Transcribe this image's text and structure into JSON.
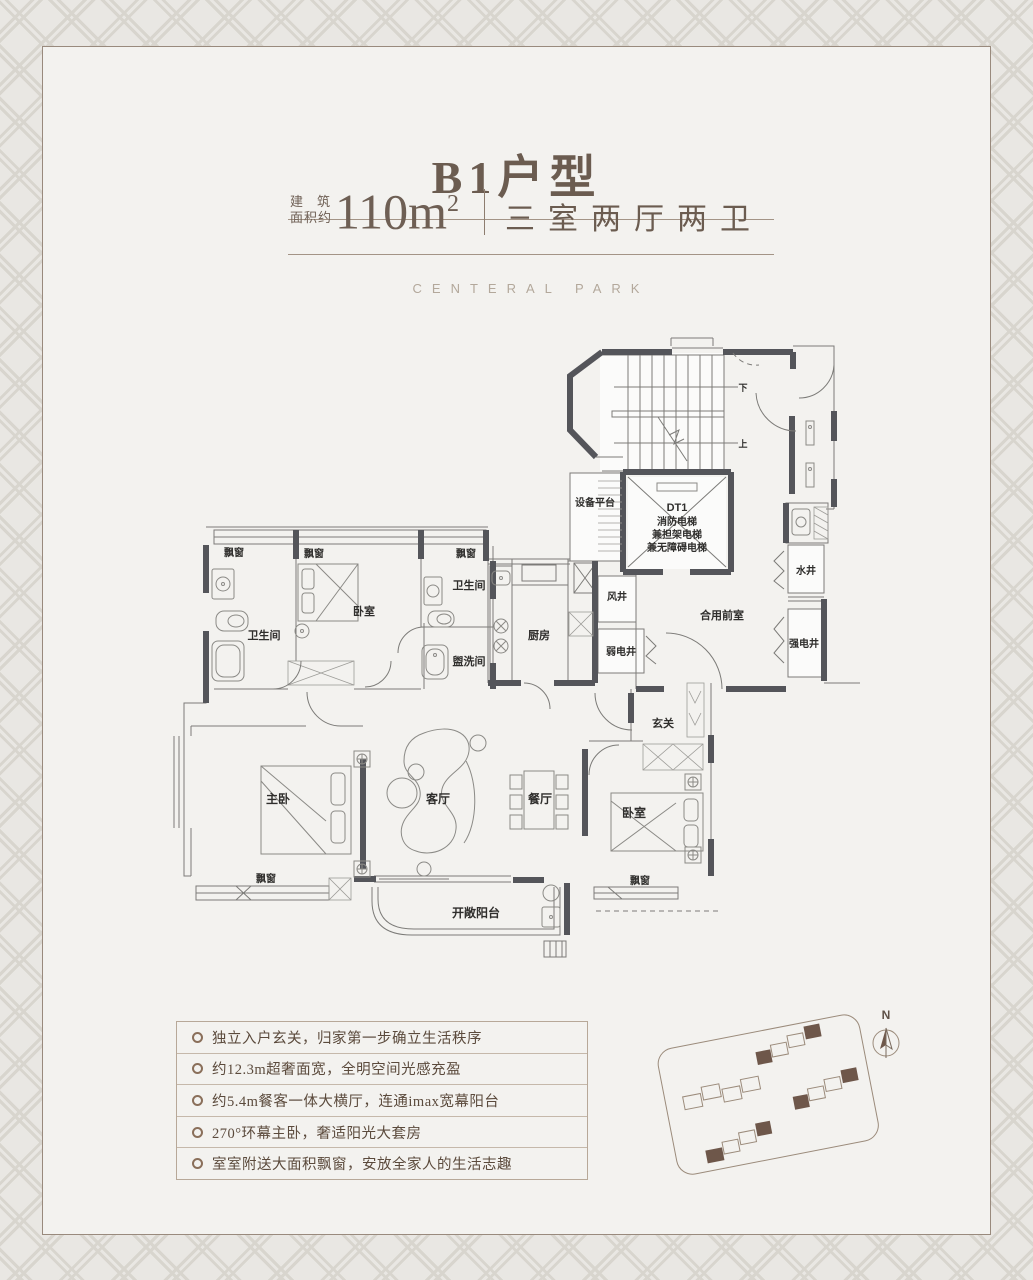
{
  "header": {
    "title": "B1户型",
    "area_label_line1": "建筑",
    "area_label_line2": "面积约",
    "area_value": "110m",
    "area_sup": "2",
    "layout": "三室两厅两卫",
    "brand": "CENTERAL PARK"
  },
  "plan": {
    "labels": {
      "bay_window": "飘窗",
      "bedroom": "卧室",
      "master": "主卧",
      "living": "客厅",
      "dining": "餐厅",
      "bath": "卫生间",
      "wash": "盥洗间",
      "kitchen": "厨房",
      "balcony": "开敞阳台",
      "foyer": "玄关",
      "lobby": "合用前室",
      "equipment": "设备平台",
      "water_shaft": "水井",
      "strong_elec_shaft": "强电井",
      "weak_elec_shaft": "弱电井",
      "air_shaft": "风井",
      "elevator_line1": "DT1",
      "elevator_line2": "消防电梯",
      "elevator_line3": "兼担架电梯",
      "elevator_line4": "兼无障碍电梯",
      "stairs_down": "下",
      "stairs_up": "上"
    }
  },
  "features": {
    "items": [
      "独立入户玄关，归家第一步确立生活秩序",
      "约12.3m超奢面宽，全明空间光感充盈",
      "约5.4m餐客一体大横厅，连通imax宽幕阳台",
      "270°环幕主卧，奢适阳光大套房",
      "室室附送大面积飘窗，安放全家人的生活志趣"
    ]
  },
  "siteplan": {
    "north_label": "N",
    "highlight_color": "#6e574a"
  }
}
